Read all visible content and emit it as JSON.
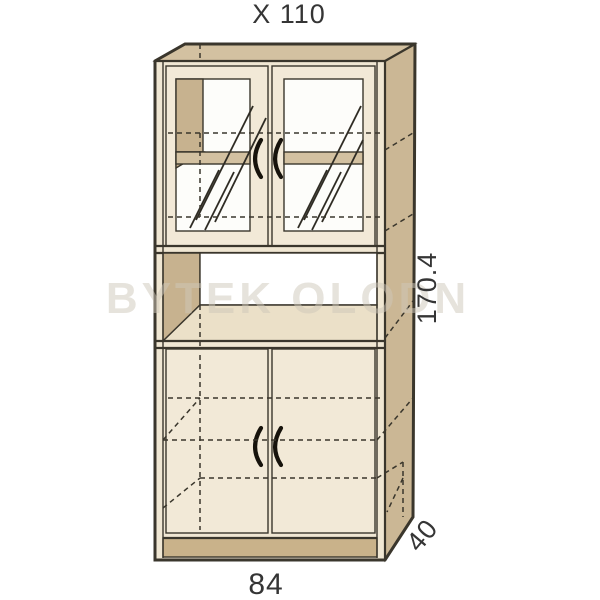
{
  "labels": {
    "top_dimension": "X 110",
    "height_dimension": "170.4",
    "depth_dimension": "40",
    "width_dimension": "84"
  },
  "watermark": "BYTEK OLODN",
  "colors": {
    "wood_top": "#d3c1a1",
    "wood_side": "#cbb795",
    "wood_interior": "#c7b28f",
    "front": "#f0e7d3",
    "door": "#f2e9d7",
    "glass": "#fdfdfa",
    "shelf_surface": "#ebe0c8",
    "niche_back": "#ffffff",
    "plinth": "#c9b28a",
    "outline": "#3a362c",
    "label_text": "#353535",
    "watermark_color": "#cfc8ba"
  }
}
